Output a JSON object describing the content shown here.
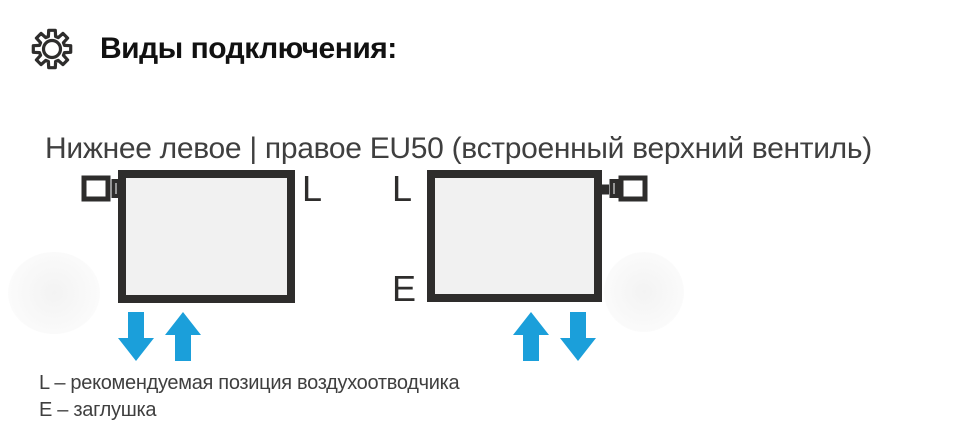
{
  "colors": {
    "dark": "#2e2d2c",
    "title_text": "#111111",
    "body_text": "#3f3f3f",
    "blue": "#1b9fda",
    "radiator_fill": "#f1f1f1",
    "white": "#ffffff"
  },
  "header": {
    "icon": "gear",
    "title": "Виды подключения:"
  },
  "section": {
    "subtitle": "Нижнее левое | правое EU50 (встроенный верхний вентиль)",
    "diagrams": [
      {
        "name": "bottom-left-connection",
        "valve_side": "top-left",
        "labels": [
          {
            "text": "L",
            "position": "top-right"
          }
        ],
        "arrows": [
          {
            "direction": "down"
          },
          {
            "direction": "up"
          }
        ],
        "arrows_position": "bottom-left"
      },
      {
        "name": "bottom-right-connection",
        "valve_side": "top-right",
        "labels": [
          {
            "text": "L",
            "position": "top-left"
          },
          {
            "text": "E",
            "position": "bottom-left"
          }
        ],
        "arrows": [
          {
            "direction": "up"
          },
          {
            "direction": "down"
          }
        ],
        "arrows_position": "bottom-right"
      }
    ],
    "legend": [
      "L – рекомендуемая позиция воздухоотводчика",
      "E – заглушка"
    ]
  }
}
